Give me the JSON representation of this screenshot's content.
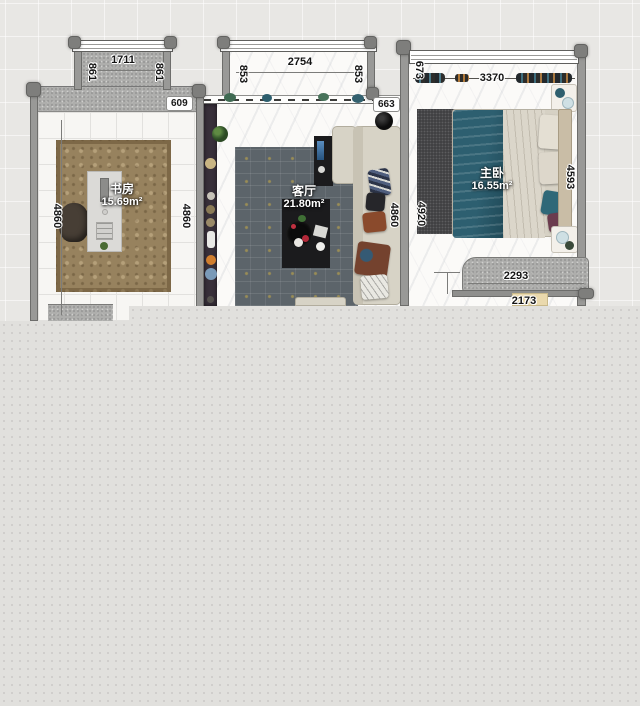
{
  "app": {
    "type": "floor-plan-editor-canvas"
  },
  "rooms": [
    {
      "name": "书房",
      "area": "15.69m²"
    },
    {
      "name": "客厅",
      "area": "21.80m²"
    },
    {
      "name": "主卧",
      "area": "16.55m²"
    }
  ],
  "dims": {
    "study_bay_width": "1711",
    "study_bay_side_left": "861",
    "study_bay_side_right": "861",
    "study_top_offset": "609",
    "study_height_left": "4860",
    "study_height_right": "4860",
    "living_bay_width": "2754",
    "living_bay_side_left": "853",
    "living_bay_side_right": "853",
    "living_top_offset": "663",
    "living_height_right": "4860",
    "master_window_width": "3370",
    "master_top_offset": "673",
    "master_height_left": "4920",
    "master_height_right": "4593",
    "master_wardrobe_width": "2293",
    "master_bottom_width": "2173"
  },
  "colors": {
    "canvas_bg": "#e8e7e4",
    "unrendered_overlay": "#e1e0dd",
    "wall": "#999997",
    "study_rug": "#97825e",
    "living_rug": "#5c646a",
    "bedroom_rug": "#414143",
    "sofa_beige": "#d7d3c6",
    "teal_blanket": "#2d5f70"
  }
}
